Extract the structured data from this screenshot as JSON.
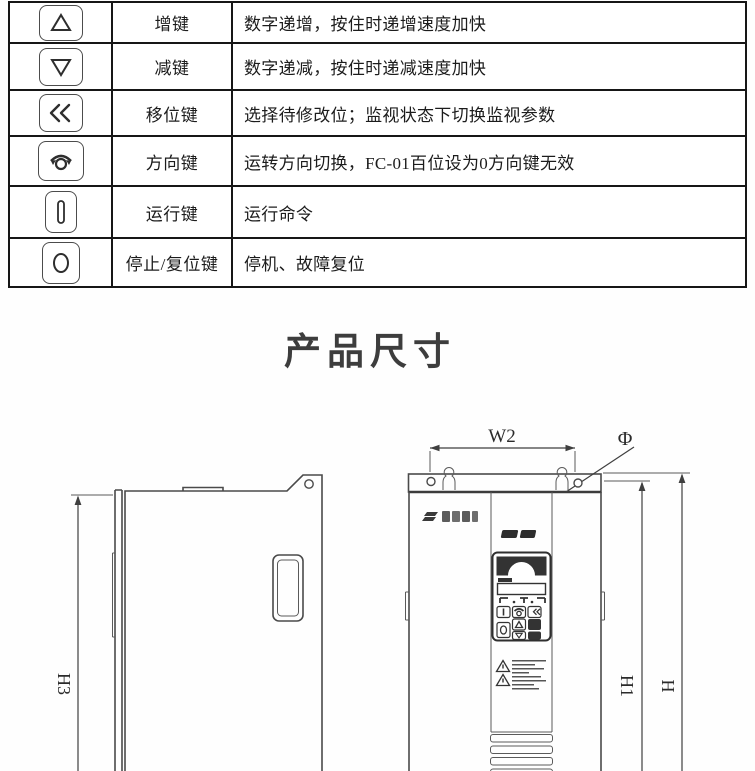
{
  "document": {
    "section_title": "产品尺寸"
  },
  "key_table": {
    "rows": [
      {
        "icon": "increase-key-icon",
        "name": "增键",
        "desc": "数字递增，按住时递增速度加快"
      },
      {
        "icon": "decrease-key-icon",
        "name": "减键",
        "desc": "数字递减，按住时递减速度加快"
      },
      {
        "icon": "shift-key-icon",
        "name": "移位键",
        "desc": "选择待修改位；监视状态下切换监视参数"
      },
      {
        "icon": "direction-key-icon",
        "name": "方向键",
        "desc": "运转方向切换，FC-01百位设为0方向键无效"
      },
      {
        "icon": "run-key-icon",
        "name": "运行键",
        "desc": "运行命令"
      },
      {
        "icon": "stop-reset-key-icon",
        "name": "停止/复位键",
        "desc": "停机、故障复位"
      }
    ]
  },
  "dims": {
    "w2": "W2",
    "phi": "Φ",
    "h1": "H1",
    "h": "H",
    "h3": "H3"
  },
  "colors": {
    "line": "#4a4a4a",
    "table_border": "#161616",
    "title": "#3d3d3d",
    "keypad_dark": "#333333"
  }
}
